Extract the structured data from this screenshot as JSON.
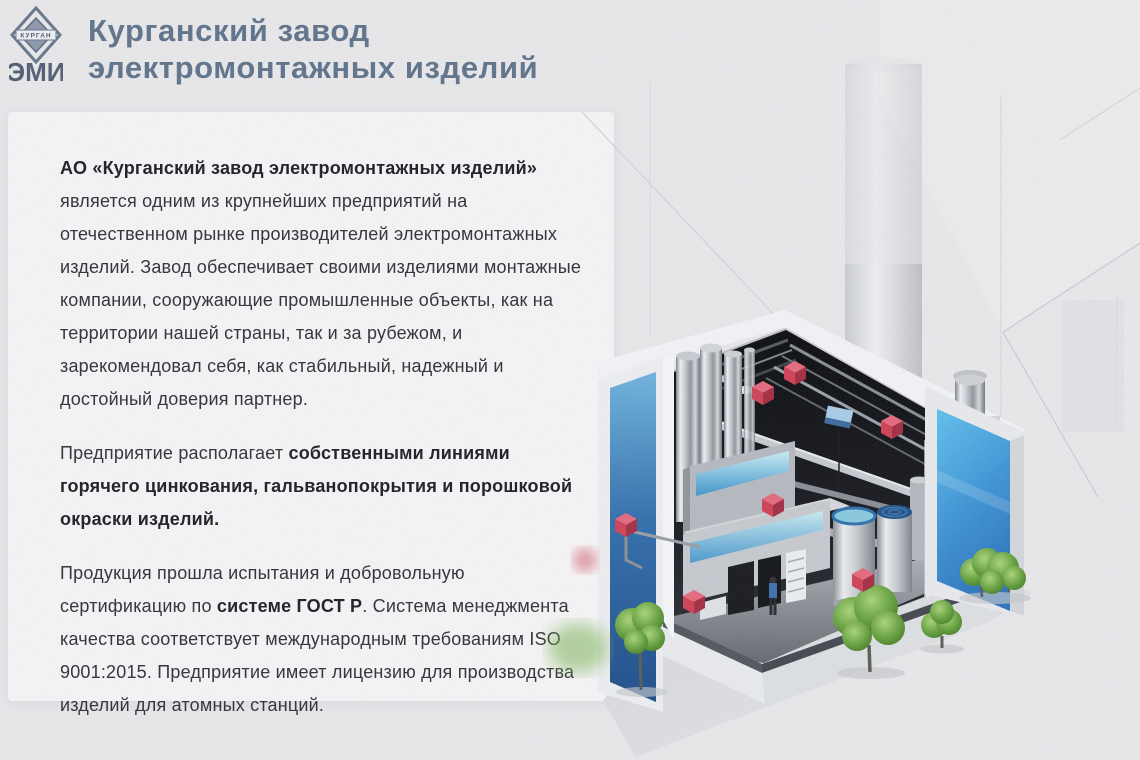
{
  "palette": {
    "page_bg": "#e9e9ec",
    "card_bg": "#f6f6f8",
    "title_slate": "#5d7189",
    "text_dark": "#2d2d33",
    "accent_red": "#cf3f55",
    "accent_red_light": "#e5677b",
    "accent_red_dark": "#a32a3f",
    "wall_blue": "#2d77c0",
    "wall_blue_light": "#4ab2e6",
    "tree_green": "#5f9c38"
  },
  "header": {
    "logo_banner": "КУРГАН",
    "logo_letters": "ЭМИ",
    "title_line1": "Курганский завод",
    "title_line2": "электромонтажных изделий"
  },
  "about_card": {
    "p1_bold": "АО «Курганский завод электромонтажных изделий»",
    "p1_text": " является одним из крупнейших предприятий на отечественном рынке производителей электромонтажных изделий. Завод обеспечивает своими изделиями монтажные компании, сооружающие промышленные объекты, как на территории нашей страны, так и за рубежом, и зарекомендовал себя, как стабильный, надежный и достойный доверия партнер.",
    "p2_text": "Предприятие располагает ",
    "p2_bold": "собственными линиями горячего цинкования, гальванопокрытия и порошковой окраски изделий.",
    "p3_text1": "Продукция прошла испытания и добровольную сертификацию по ",
    "p3_bold": "системе ГОСТ Р",
    "p3_text2": ". Система менеджмента качества соответствует международным требованиям ISO 9001:2015. Предприятие имеет лицензию для производства изделий для атомных станций."
  },
  "illustration": {
    "alt": "Изометрическая 3D-схема модульного производственного здания в разрезе: синие стеновые панели, оборудование линий цинкования и окраски, резервуары, деревья и красные маркеры продукции",
    "hotspot_count": 7
  }
}
